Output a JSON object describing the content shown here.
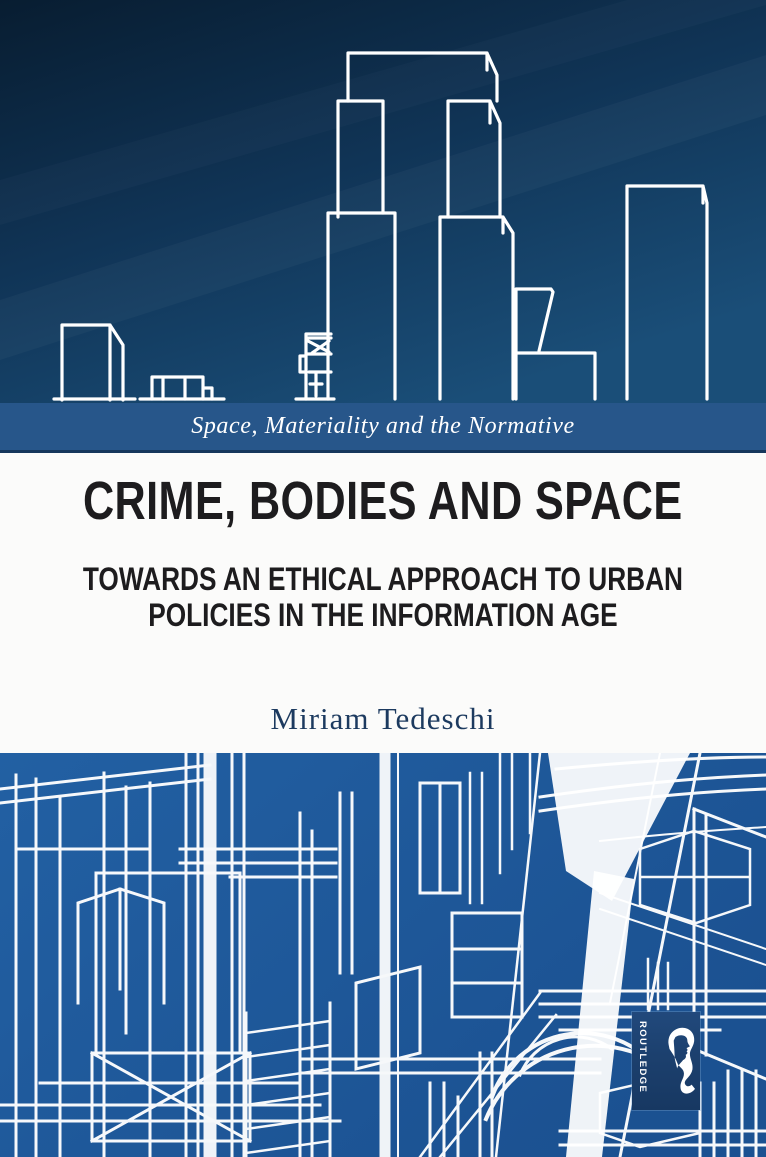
{
  "cover": {
    "series_banner": "Space, Materiality and the Normative",
    "title": "CRIME, BODIES AND SPACE",
    "subtitle_lines": [
      "TOWARDS AN ETHICAL APPROACH TO URBAN",
      "POLICIES IN THE INFORMATION AGE"
    ],
    "author": "Miriam Tedeschi",
    "publisher": {
      "name": "Routledge",
      "wordmark": "ROUTLEDGE"
    },
    "colors": {
      "sky_top": "#081d31",
      "sky_bottom": "#1a4e78",
      "banner_blue": "#27568a",
      "banner_edge": "#16375c",
      "city_blue": "#1e5a9e",
      "logo_navy": "#1c406e",
      "title_black": "#1d1c1e",
      "author_navy": "#1c3a5f",
      "line_white": "#ffffff"
    }
  }
}
